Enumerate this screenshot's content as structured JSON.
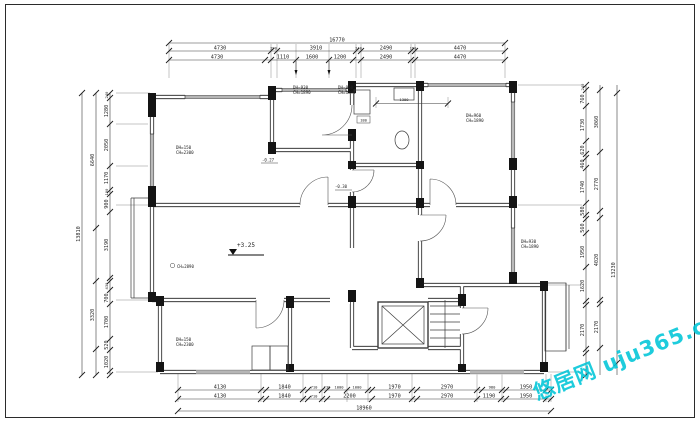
{
  "watermark": {
    "text": "悠居网 uju365.com",
    "color": "#00C6D8"
  },
  "levels": {
    "main": "+3.25",
    "living_ceiling": "CH=2890",
    "hall": "-0.30",
    "entry": "-0.27"
  },
  "window_labels": [
    {
      "line1": "DH=150",
      "line2": "CH=2300"
    },
    {
      "line1": "DH=930",
      "line2": "CH=1890"
    },
    {
      "line1": "DH=960",
      "line2": "CH=1890"
    },
    {
      "line1": "DH=960",
      "line2": "CH=1890"
    },
    {
      "line1": "DH=930",
      "line2": "CH=1890"
    },
    {
      "line1": "DH=150",
      "line2": "CH=2300"
    }
  ],
  "dims": {
    "top": {
      "total": "16770",
      "row1": [
        "4730",
        "290",
        "3910",
        "240",
        "2490",
        "190",
        "4470"
      ],
      "row2": [
        "4730",
        "1110",
        "1600",
        "1200",
        "2490",
        "4470"
      ]
    },
    "bottom": {
      "row1": [
        "4130",
        "1840",
        "710",
        "230",
        "1000",
        "1000",
        "1970",
        "2970",
        "980",
        "1950"
      ],
      "row2": [
        "4130",
        "1840",
        "710",
        "2200",
        "1970",
        "2970",
        "1190",
        "1950"
      ],
      "total": "18960"
    },
    "left": {
      "inner": [
        "240",
        "1280",
        "2050",
        "1170",
        "190",
        "900",
        "3190",
        "430",
        "700",
        "1700",
        "520",
        "1020"
      ],
      "mid": [
        "6640",
        "3320"
      ],
      "total": "13810"
    },
    "right": {
      "inner": [
        "240",
        "760",
        "1730",
        "620",
        "460",
        "1740",
        "580",
        "560",
        "1950",
        "1620",
        "2170"
      ],
      "mid": [
        "3060",
        "2770",
        "4020",
        "2170"
      ],
      "total": "13230"
    },
    "interior": {
      "bath_width": "1300",
      "niche": "180"
    }
  }
}
